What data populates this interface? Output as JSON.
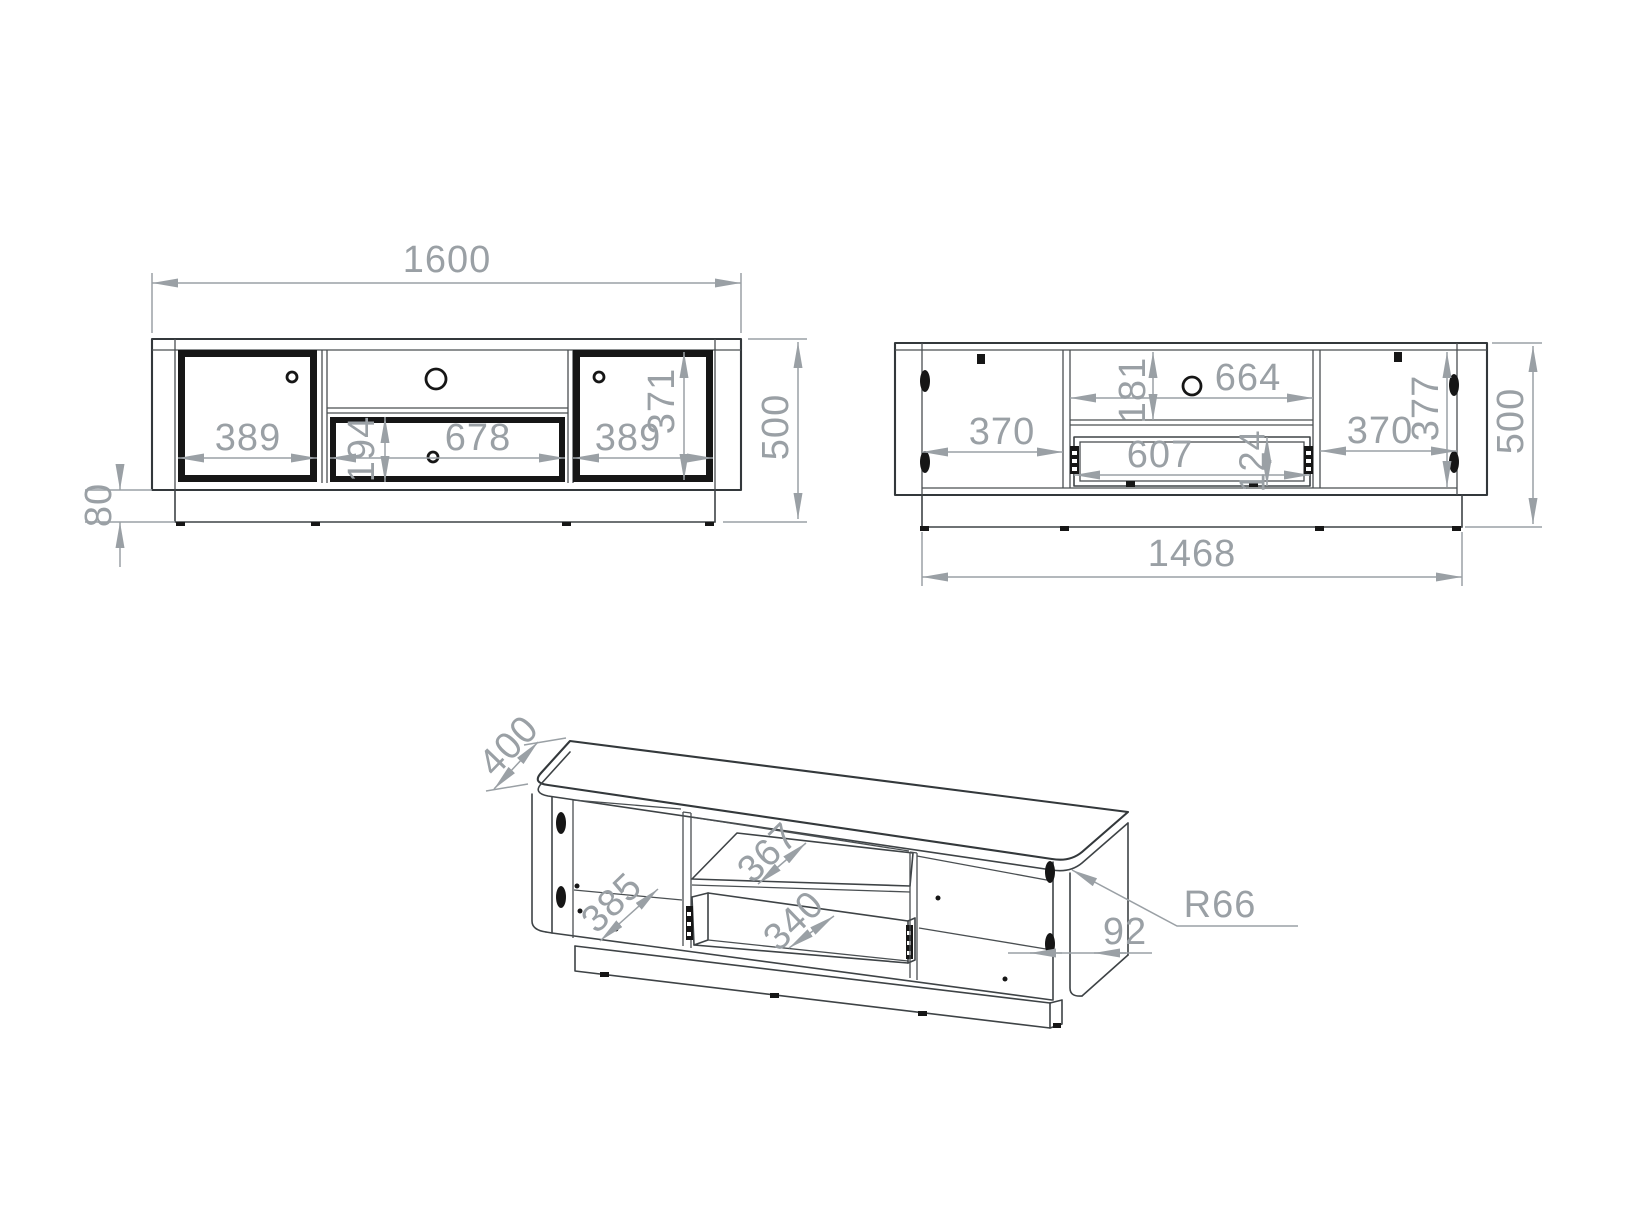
{
  "drawing": {
    "type": "furniture-technical-drawing",
    "subject": "TV stand / lowboard cabinet, three orthographic-axonometric views",
    "background": "#ffffff",
    "line_color": "#3e4346",
    "dimension_color": "#9aa0a5",
    "views": {
      "front": {
        "label": "front-elevation",
        "dims": {
          "total_width": "1600",
          "left_door_width": "389",
          "drawer_width": "678",
          "right_door_width": "389",
          "drawer_height": "194",
          "door_height": "371",
          "total_height": "500",
          "plinth_height": "80"
        }
      },
      "back": {
        "label": "rear-elevation",
        "dims": {
          "left_opening_width": "370",
          "niche_height": "181",
          "niche_width": "664",
          "drawer_box_width": "607",
          "drawer_box_height": "124",
          "right_opening_width": "370",
          "interior_height": "377",
          "total_height": "500",
          "base_width": "1468"
        }
      },
      "iso": {
        "label": "isometric-view",
        "dims": {
          "depth": "400",
          "interior_depth": "385",
          "shelf_depth": "367",
          "drawer_depth": "340",
          "corner_radius": "R66",
          "side_thickness": "92"
        }
      }
    }
  }
}
